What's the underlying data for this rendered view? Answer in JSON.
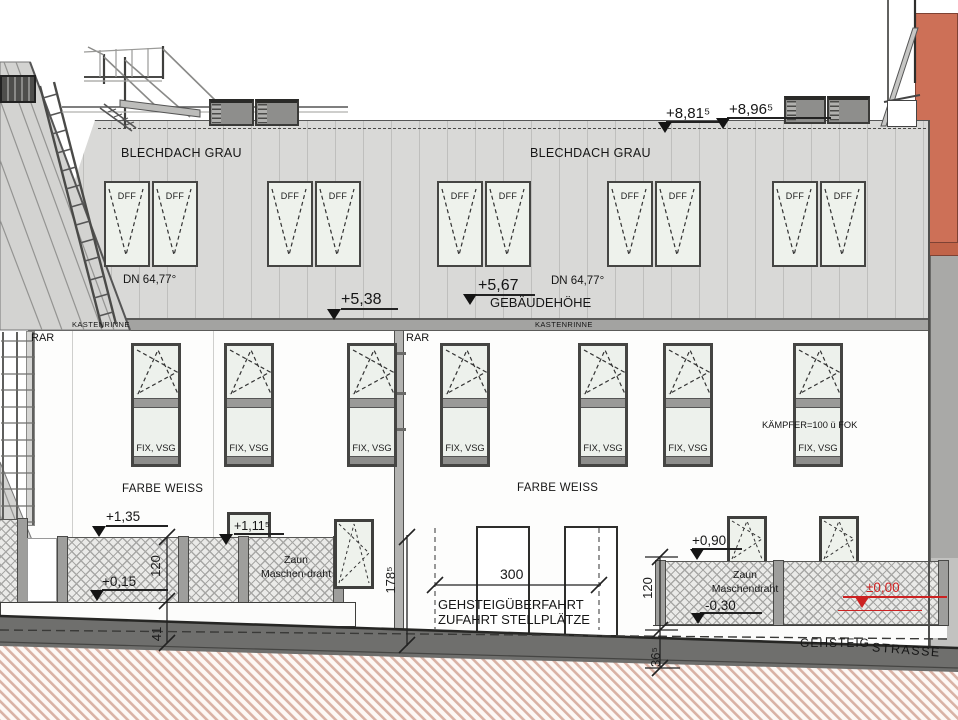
{
  "roof": {
    "label_left": "BLECHDACH GRAU",
    "label_right": "BLECHDACH GRAU",
    "slope_left": "DN 64,77°",
    "slope_right": "DN 64,77°",
    "dff": "DFF",
    "gutter_left": "KASTENRINNE",
    "gutter_right": "KASTENRINNE"
  },
  "levels": {
    "parapet": "+8,96⁵",
    "roof_edge": "+8,81⁵",
    "building_height_value": "+5,67",
    "building_height_label": "GEBÄUDEHÖHE",
    "gutter": "+5,38",
    "fence_left_top": "+1,35",
    "fence_left_bottom": "+0,15",
    "sill": "+1,11⁵",
    "fence_right_top": "+0,90",
    "fence_right_bottom": "-0,30",
    "street_zero": "±0,00"
  },
  "facade": {
    "downpipe_left": "RAR",
    "downpipe_right": "RAR",
    "window_label": "FIX, VSG",
    "kampfer_note": "KÄMPFER=100 ü FOK",
    "color_left": "FARBE WEISS",
    "color_right": "FARBE WEISS"
  },
  "fence": {
    "left_line1": "Zaun",
    "left_line2": "Maschen-draht",
    "right_line1": "Zaun",
    "right_line2": "Maschendraht"
  },
  "dims": {
    "fence_left_h": "120",
    "plinth_left": "41",
    "wall_h": "178⁵",
    "drive_w": "300",
    "fence_right_h": "120",
    "curb": "36⁵"
  },
  "ground": {
    "drive1": "GEHSTEIGÜBERFAHRT",
    "drive2": "ZUFAHRT STELLPLÄTZE",
    "sidewalk": "GEHSTEIG",
    "street": "STRASSE"
  },
  "colors": {
    "neighbor_orange": "#cd7057",
    "roof_gray": "#d9d9d7",
    "gutter_band": "#a3a3a1",
    "street_gray": "#6f6f6d",
    "earth_hatch": "#d9b2a5",
    "level_accent_red": "#cc2222"
  }
}
